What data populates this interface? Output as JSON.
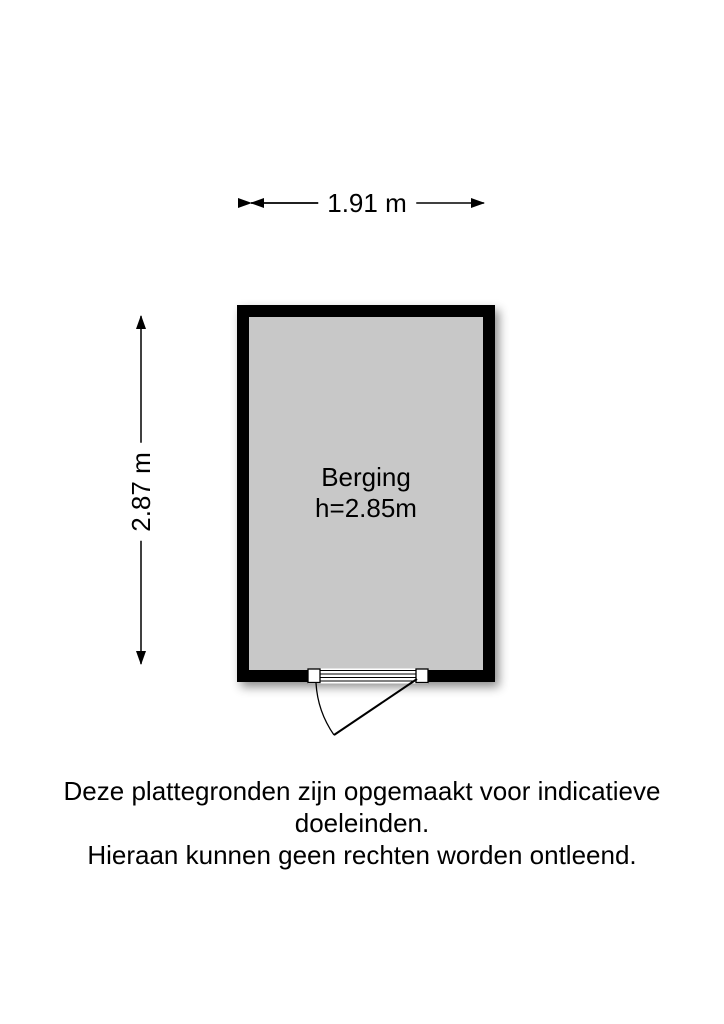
{
  "floorplan": {
    "room": {
      "name": "Berging",
      "ceiling_height": "h=2.85m"
    },
    "dimensions": {
      "width": "1.91 m",
      "height": "2.87 m"
    }
  },
  "disclaimer": {
    "line1": "Deze plattegronden zijn opgemaakt voor indicatieve doeleinden.",
    "line2": "Hieraan kunnen geen rechten worden ontleend."
  },
  "colors": {
    "background": "#ffffff",
    "wall": "#000000",
    "floor": "#c8c8c8",
    "line": "#000000",
    "text": "#000000"
  }
}
